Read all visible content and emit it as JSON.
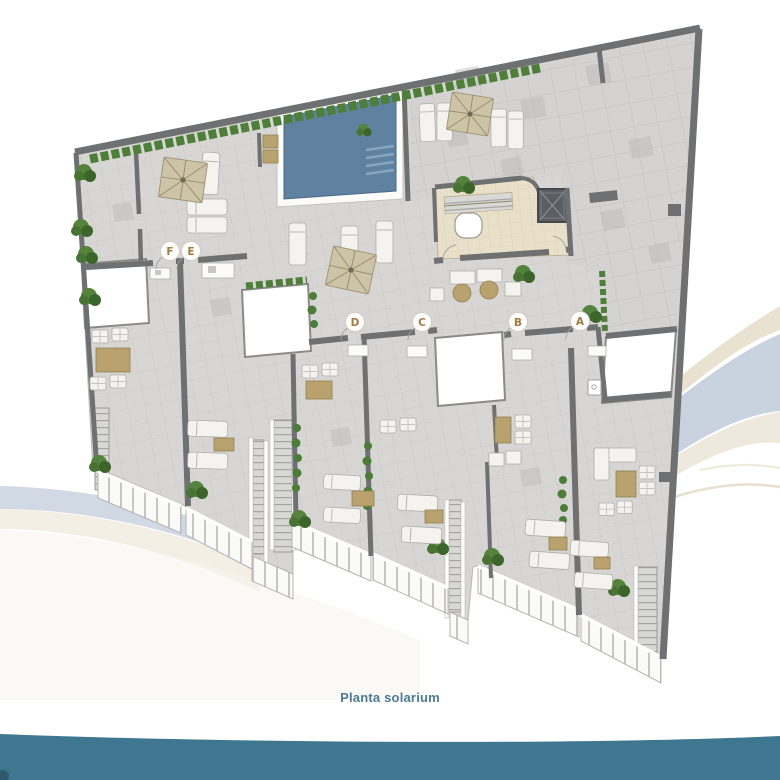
{
  "caption": {
    "text": "Planta solarium"
  },
  "markers": [
    {
      "label": "F",
      "x": 170,
      "y": 251
    },
    {
      "label": "E",
      "x": 191,
      "y": 251
    },
    {
      "label": "D",
      "x": 355,
      "y": 322
    },
    {
      "label": "C",
      "x": 422,
      "y": 322
    },
    {
      "label": "B",
      "x": 518,
      "y": 322
    },
    {
      "label": "A",
      "x": 580,
      "y": 321
    }
  ],
  "colors": {
    "accent_text": "#4a7b97",
    "wave_band": "#3f7690",
    "pool_water": "#5e82a0",
    "pool_steps": "#8aa5bb",
    "parasol": "#cdc3a7",
    "parasol_rib": "#9a8f6d",
    "marker_letter": "#a5793a",
    "wall": "#6e7071",
    "floor": "#d7d6d4",
    "floor_line": "#c6c5c3",
    "core_floor": "#e9e0ca",
    "swoosh_blue": "#c9d2df",
    "swoosh_beige": "#e9e2d1",
    "hedge": "#4e7f38",
    "hedge_dark": "#3a6326",
    "lounger": "#f4f3f0",
    "table_tan": "#b9a26e",
    "railing": "#f8f8f6",
    "stair": "#d8d8d6"
  }
}
